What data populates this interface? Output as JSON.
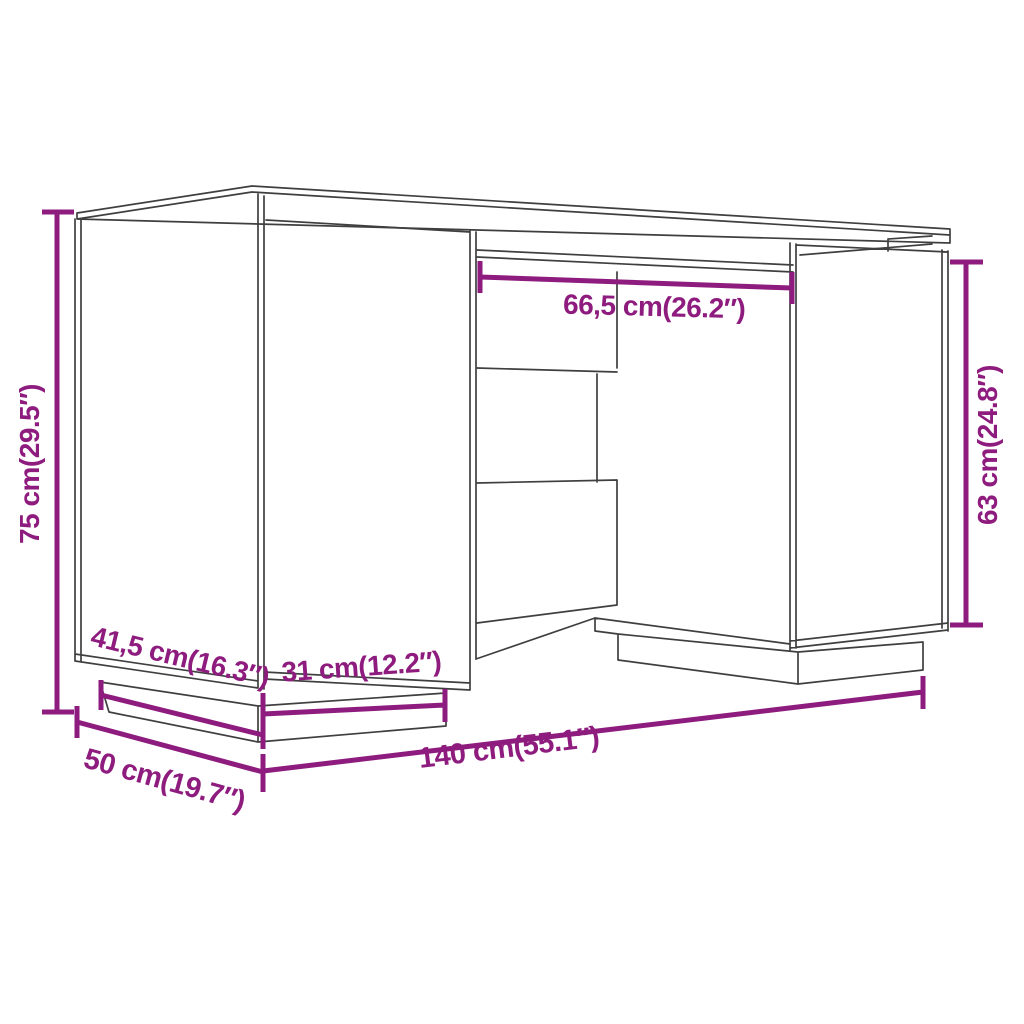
{
  "diagram": {
    "title": "Desk dimension diagram",
    "object": "desk with left door cabinet, right door cabinet, center drawers and recessed plinth bases",
    "colors": {
      "background": "#ffffff",
      "outline": "#3f3f3f",
      "dimension": "#8E1C7E"
    },
    "dimensions": [
      {
        "id": "overall-height",
        "label": "75 cm(29.5″)",
        "cm": "75",
        "inches": "29.5"
      },
      {
        "id": "knee-space-width",
        "label": "66,5 cm(26.2″)",
        "cm": "66,5",
        "inches": "26.2"
      },
      {
        "id": "cabinet-height",
        "label": "63 cm(24.8″)",
        "cm": "63",
        "inches": "24.8"
      },
      {
        "id": "plinth-depth",
        "label": "41,5 cm(16.3″)",
        "cm": "41,5",
        "inches": "16.3"
      },
      {
        "id": "plinth-width",
        "label": "31 cm(12.2″)",
        "cm": "31",
        "inches": "12.2"
      },
      {
        "id": "overall-depth",
        "label": "50 cm(19.7″)",
        "cm": "50",
        "inches": "19.7"
      },
      {
        "id": "overall-width",
        "label": "140 cm(55.1″)",
        "cm": "140",
        "inches": "55.1"
      }
    ]
  }
}
